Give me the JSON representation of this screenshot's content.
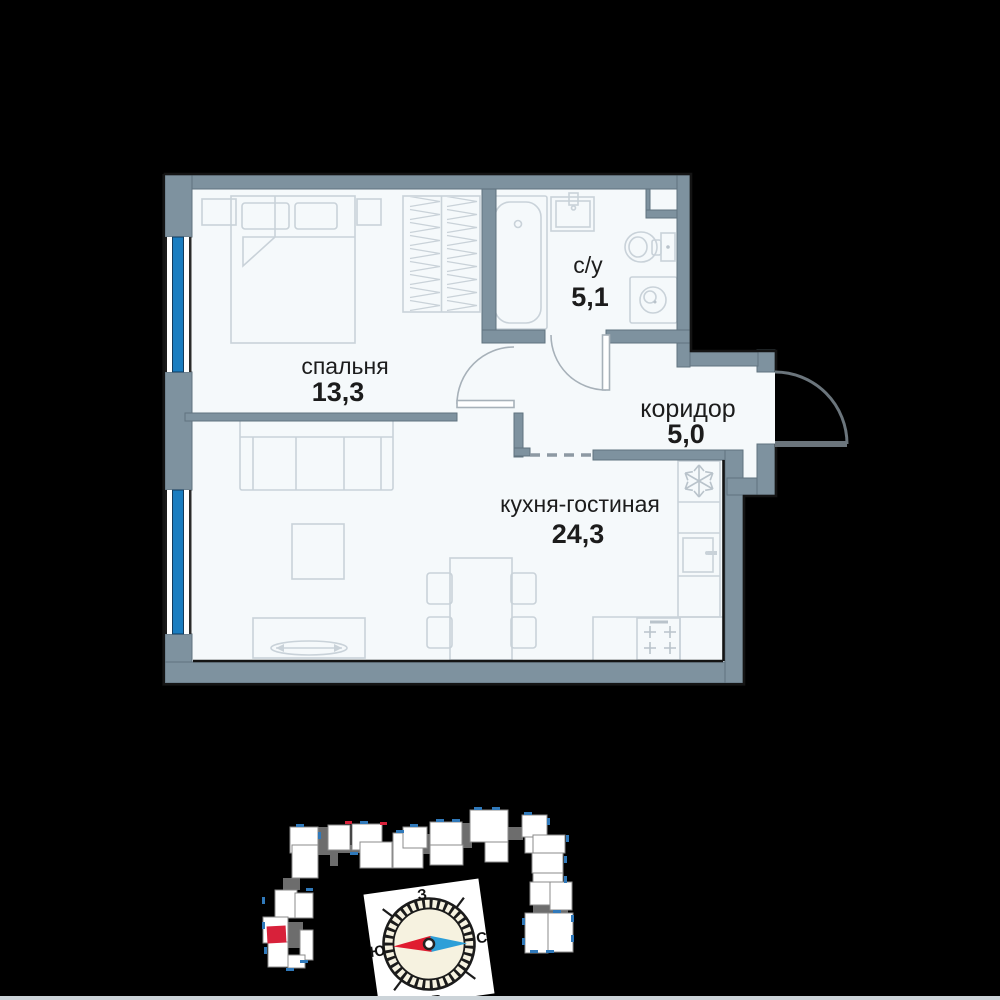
{
  "plan": {
    "rooms": [
      {
        "name": "спальня",
        "area": "13,3"
      },
      {
        "name": "с/у",
        "area": "5,1"
      },
      {
        "name": "коридор",
        "area": "5,0"
      },
      {
        "name": "кухня-гостиная",
        "area": "24,3"
      }
    ]
  },
  "compass": {
    "west": "З",
    "south": "Ю",
    "north": "С",
    "east": "В"
  },
  "colors": {
    "background": "#000000",
    "wall": "#7e929f",
    "floor": "#f5f9fb",
    "window_glass": "#1b7dc0",
    "furniture_line": "#c9d2d9",
    "text": "#1c1c1c",
    "site_building": "#ffffff",
    "site_core": "#6d6d6d",
    "site_balcony": "#3079ba",
    "highlight_red": "#d8213a",
    "needle_red": "#e01c30",
    "needle_blue": "#2d9fd8",
    "compass_face": "#f6f2e0"
  }
}
